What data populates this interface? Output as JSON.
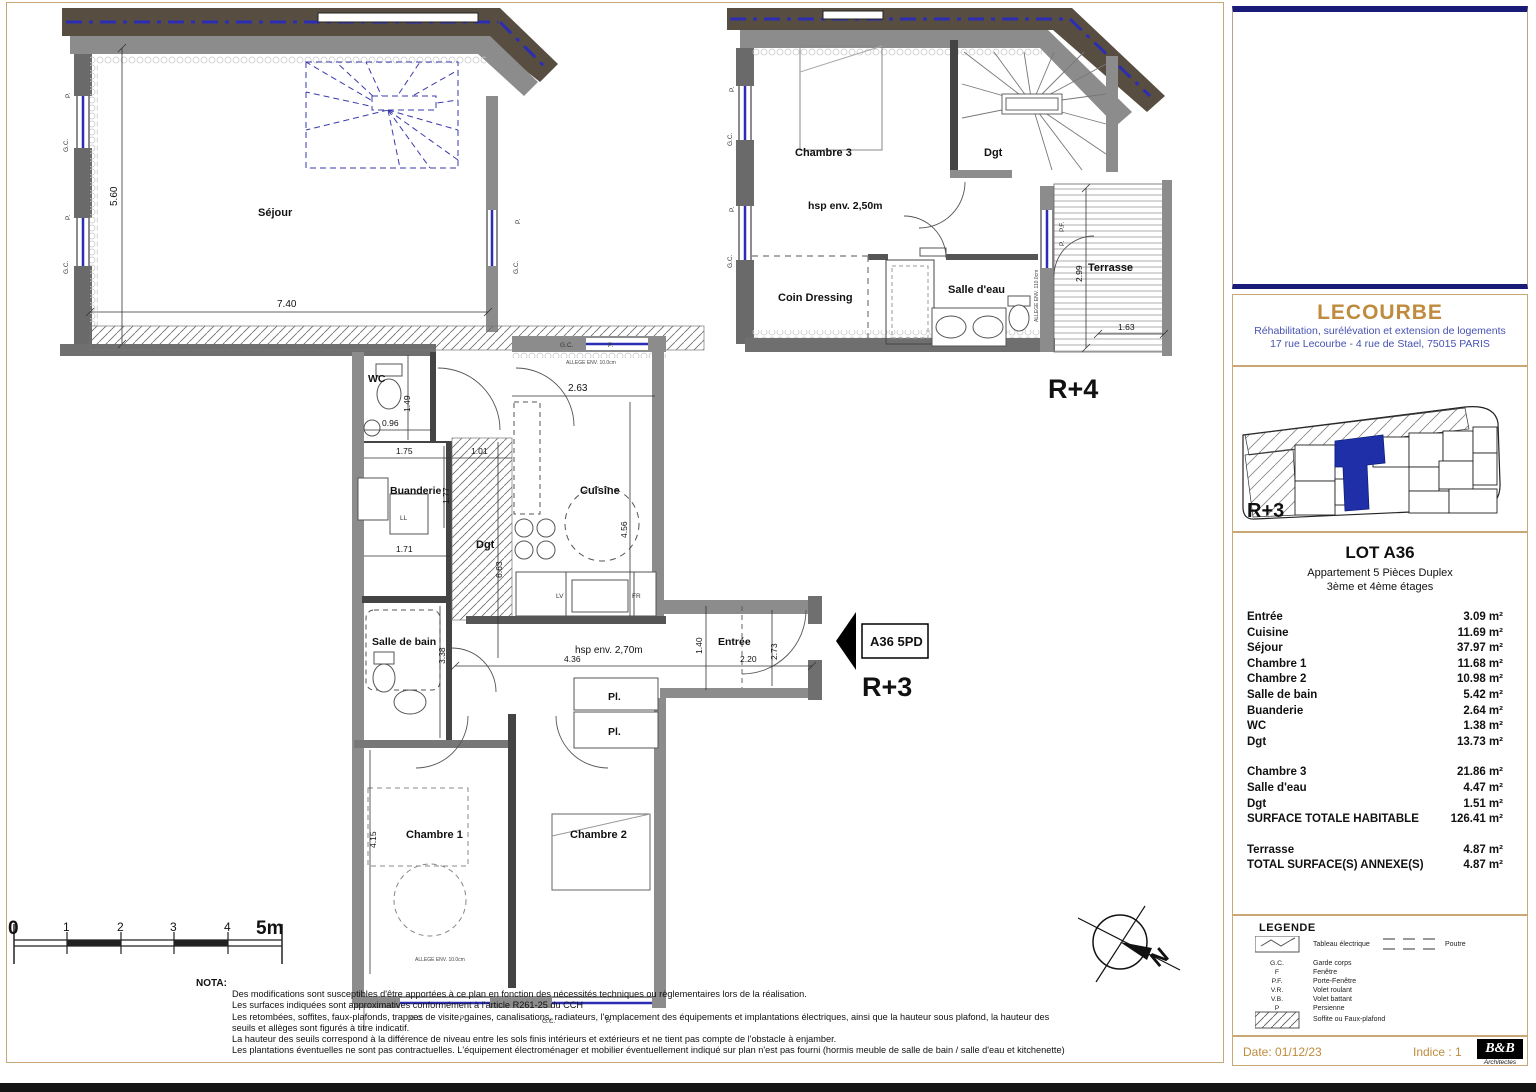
{
  "plans": {
    "r3": {
      "label": "R+3",
      "tag": "A36 5PD",
      "rooms": {
        "sejour": "Séjour",
        "wc": "WC",
        "buanderie": "Buanderie",
        "dgt": "Dgt",
        "cuisine": "Cuisine",
        "sdb": "Salle de bain",
        "entree": "Entrée",
        "pl": "Pl.",
        "chambre1": "Chambre 1",
        "chambre2": "Chambre 2"
      },
      "dims": {
        "d560": "5.60",
        "d740": "7.40",
        "d149": "1.49",
        "d096": "0.96",
        "d175": "1.75",
        "d101": "1.01",
        "d177": "1.77",
        "d171": "1.71",
        "d263": "2.63",
        "d456": "4.56",
        "d663": "6.63",
        "d338": "3.38",
        "d436": "4.36",
        "d273": "2.73",
        "d140": "1.40",
        "d220": "2.20",
        "d415": "4.15"
      },
      "ann": {
        "hsp": "hsp env. 2,70m",
        "lv": "LV",
        "fr": "FR",
        "ll": "LL",
        "gc": "G.C.",
        "p": "P.",
        "allege": "ALLEGE ENV. 10.0cm"
      }
    },
    "r4": {
      "label": "R+4",
      "rooms": {
        "chambre3": "Chambre 3",
        "dgt": "Dgt",
        "coin_dressing": "Coin Dressing",
        "salle_deau": "Salle d'eau",
        "terrasse": "Terrasse"
      },
      "dims": {
        "d299": "2.99",
        "d163": "1.63"
      },
      "ann": {
        "hsp": "hsp env. 2,50m",
        "pf": "P.F.",
        "p": "P.",
        "gc": "G.C.",
        "allege": "ALLEGE ENV. 110.0cm"
      }
    }
  },
  "scalebar": {
    "m0": "0",
    "m1": "1",
    "m2": "2",
    "m3": "3",
    "m4": "4",
    "m5": "5m"
  },
  "compass": {
    "n": "N"
  },
  "nota": {
    "title": "NOTA:",
    "line1": "Des modifications sont susceptibles d'être apportées à ce plan en fonction des nécessités techniques ou règlementaires lors de la réalisation.",
    "line2": "Les surfaces indiquées sont approximatives conformément à l'article R261-25 du CCH",
    "line3": "Les retombées, soffites, faux-plafonds, trappes de visite, gaines, canalisations, radiateurs, l'emplacement des équipements et implantations électriques, ainsi que la hauteur sous plafond, la hauteur des",
    "line4": "seuils et allèges sont figurés à titre indicatif.",
    "line5": "La hauteur des seuils correspond à la différence de niveau entre les sols finis intérieurs et extérieurs et ne tient pas compte de l'obstacle à enjamber.",
    "line6": "Les plantations éventuelles ne sont pas contractuelles. L'équipement électroménager et mobilier éventuellement indiqué sur plan n'est pas fourni (hormis meuble de salle de bain / salle d'eau et kitchenette)"
  },
  "titleblock": {
    "project": "LECOURBE",
    "sub1": "Réhabilitation, surélévation et extension de logements",
    "sub2": "17 rue Lecourbe  - 4 rue de Stael, 75015 PARIS",
    "keyplan_label": "R+3",
    "lot": {
      "title": "LOT A36",
      "sub1": "Appartement 5 Pièces Duplex",
      "sub2": "3ème et 4ème étages",
      "rows": [
        {
          "label": "Entrée",
          "value": "3.09 m²"
        },
        {
          "label": "Cuisine",
          "value": "11.69 m²"
        },
        {
          "label": "Séjour",
          "value": "37.97 m²"
        },
        {
          "label": "Chambre 1",
          "value": "11.68 m²"
        },
        {
          "label": "Chambre 2",
          "value": "10.98 m²"
        },
        {
          "label": "Salle de bain",
          "value": "5.42 m²"
        },
        {
          "label": "Buanderie",
          "value": "2.64 m²"
        },
        {
          "label": "WC",
          "value": "1.38 m²"
        },
        {
          "label": "Dgt",
          "value": "13.73 m²"
        }
      ],
      "rows2": [
        {
          "label": "Chambre 3",
          "value": "21.86 m²"
        },
        {
          "label": "Salle d'eau",
          "value": "4.47 m²"
        },
        {
          "label": "Dgt",
          "value": "1.51 m²"
        },
        {
          "label": "SURFACE TOTALE HABITABLE",
          "value": "126.41 m²"
        }
      ],
      "rows3": [
        {
          "label": "Terrasse",
          "value": "4.87 m²"
        },
        {
          "label": "TOTAL SURFACE(S) ANNEXE(S)",
          "value": "4.87 m²"
        }
      ]
    },
    "legend": {
      "title": "LEGENDE",
      "tableau": "Tableau électrique",
      "poutre": "Poutre",
      "items": [
        {
          "abbr": "G.C.",
          "label": "Garde corps"
        },
        {
          "abbr": "F",
          "label": "Fenêtre"
        },
        {
          "abbr": "P.F.",
          "label": "Porte-Fenêtre"
        },
        {
          "abbr": "V.R.",
          "label": "Volet roulant"
        },
        {
          "abbr": "V.B.",
          "label": "Volet battant"
        },
        {
          "abbr": "P",
          "label": "Persienne"
        }
      ],
      "soffite": "Soffite ou Faux-plafond"
    },
    "footer": {
      "date": "Date:  01/12/23",
      "indice": "Indice : 1",
      "logo": "B&B",
      "logo_sub": "Architectes"
    }
  }
}
